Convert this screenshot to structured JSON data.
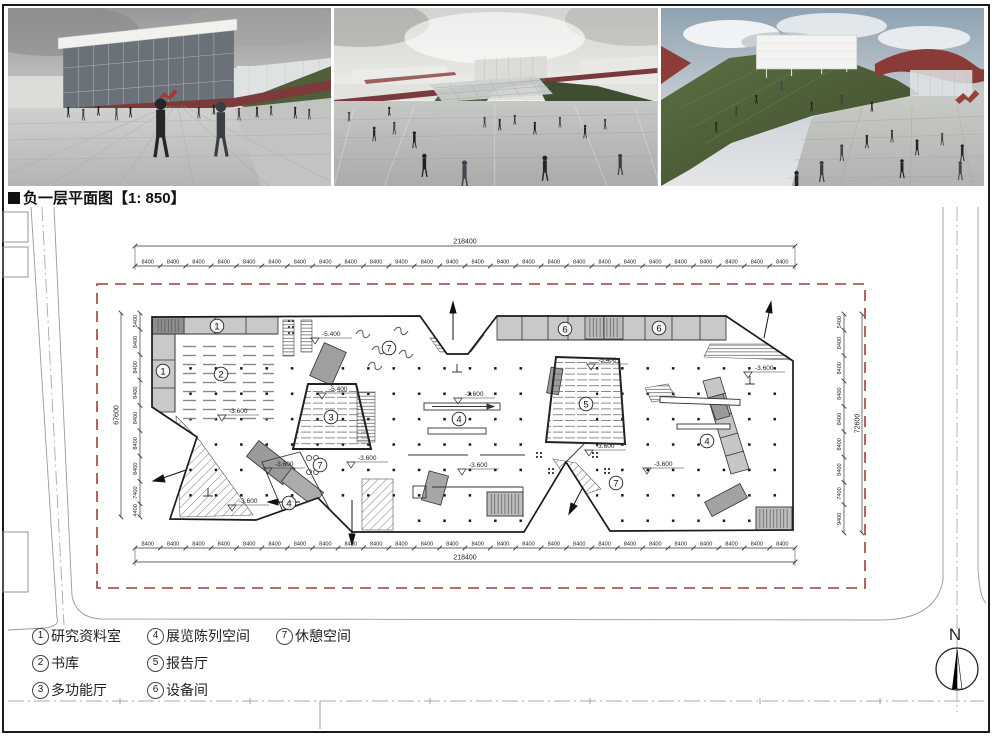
{
  "board": {
    "title": "负一层平面图【1: 850】"
  },
  "plan": {
    "boundary_color": "#a23b3b",
    "dimensions": {
      "top": {
        "total": "218400",
        "segments": [
          "8400",
          "8400",
          "8400",
          "8400",
          "8400",
          "8400",
          "8400",
          "8400",
          "8400",
          "8400",
          "8400",
          "8400",
          "8400",
          "8400",
          "8400",
          "8400",
          "8400",
          "8400",
          "8400",
          "8400",
          "8400",
          "8400",
          "8400",
          "8400",
          "8400",
          "8400"
        ]
      },
      "bottom": {
        "total": "218400",
        "segments": [
          "8400",
          "8400",
          "8400",
          "8400",
          "8400",
          "8400",
          "8400",
          "8400",
          "8400",
          "8400",
          "8400",
          "8400",
          "8400",
          "8400",
          "8400",
          "8400",
          "8400",
          "8400",
          "8400",
          "8400",
          "8400",
          "8400",
          "8400",
          "8400",
          "8400",
          "8400"
        ]
      },
      "left": {
        "total": "67600",
        "segments": [
          "5400",
          "8400",
          "8400",
          "8400",
          "8400",
          "8400",
          "8400",
          "7400",
          "4400"
        ]
      },
      "right": {
        "total": "72600",
        "segments": [
          "5400",
          "8400",
          "8400",
          "8400",
          "8400",
          "8400",
          "8400",
          "7400",
          "9400"
        ]
      }
    },
    "room_labels": [
      {
        "num": "1",
        "x": 217,
        "y": 326
      },
      {
        "num": "1",
        "x": 163,
        "y": 371
      },
      {
        "num": "2",
        "x": 221,
        "y": 374
      },
      {
        "num": "3",
        "x": 331,
        "y": 417
      },
      {
        "num": "4",
        "x": 459,
        "y": 419
      },
      {
        "num": "4",
        "x": 289,
        "y": 503
      },
      {
        "num": "4",
        "x": 707,
        "y": 441
      },
      {
        "num": "5",
        "x": 586,
        "y": 404
      },
      {
        "num": "6",
        "x": 565,
        "y": 329
      },
      {
        "num": "6",
        "x": 659,
        "y": 328
      },
      {
        "num": "7",
        "x": 389,
        "y": 348
      },
      {
        "num": "7",
        "x": 320,
        "y": 465
      },
      {
        "num": "7",
        "x": 616,
        "y": 483
      }
    ],
    "elevations": [
      {
        "text": "-5.400",
        "x": 326,
        "y": 336
      },
      {
        "text": "-5.400",
        "x": 333,
        "y": 391
      },
      {
        "text": "-5.400",
        "x": 602,
        "y": 362
      },
      {
        "text": "-3.600",
        "x": 233,
        "y": 413
      },
      {
        "text": "-3.600",
        "x": 279,
        "y": 466
      },
      {
        "text": "-3.600",
        "x": 362,
        "y": 460
      },
      {
        "text": "-3.600",
        "x": 243,
        "y": 503
      },
      {
        "text": "-3.600",
        "x": 469,
        "y": 396
      },
      {
        "text": "-3.600",
        "x": 473,
        "y": 467
      },
      {
        "text": "-3.600",
        "x": 600,
        "y": 448
      },
      {
        "text": "-3.600",
        "x": 658,
        "y": 466
      },
      {
        "text": "-3.600",
        "x": 759,
        "y": 370
      }
    ]
  },
  "legend": {
    "columns": [
      [
        {
          "num": "1",
          "label": "研究资料室"
        },
        {
          "num": "2",
          "label": "书库"
        },
        {
          "num": "3",
          "label": "多功能厅"
        }
      ],
      [
        {
          "num": "4",
          "label": "展览陈列空间"
        },
        {
          "num": "5",
          "label": "报告厅"
        },
        {
          "num": "6",
          "label": "设备间"
        }
      ],
      [
        {
          "num": "7",
          "label": "休憩空间"
        }
      ]
    ]
  },
  "compass": {
    "label": "N"
  }
}
